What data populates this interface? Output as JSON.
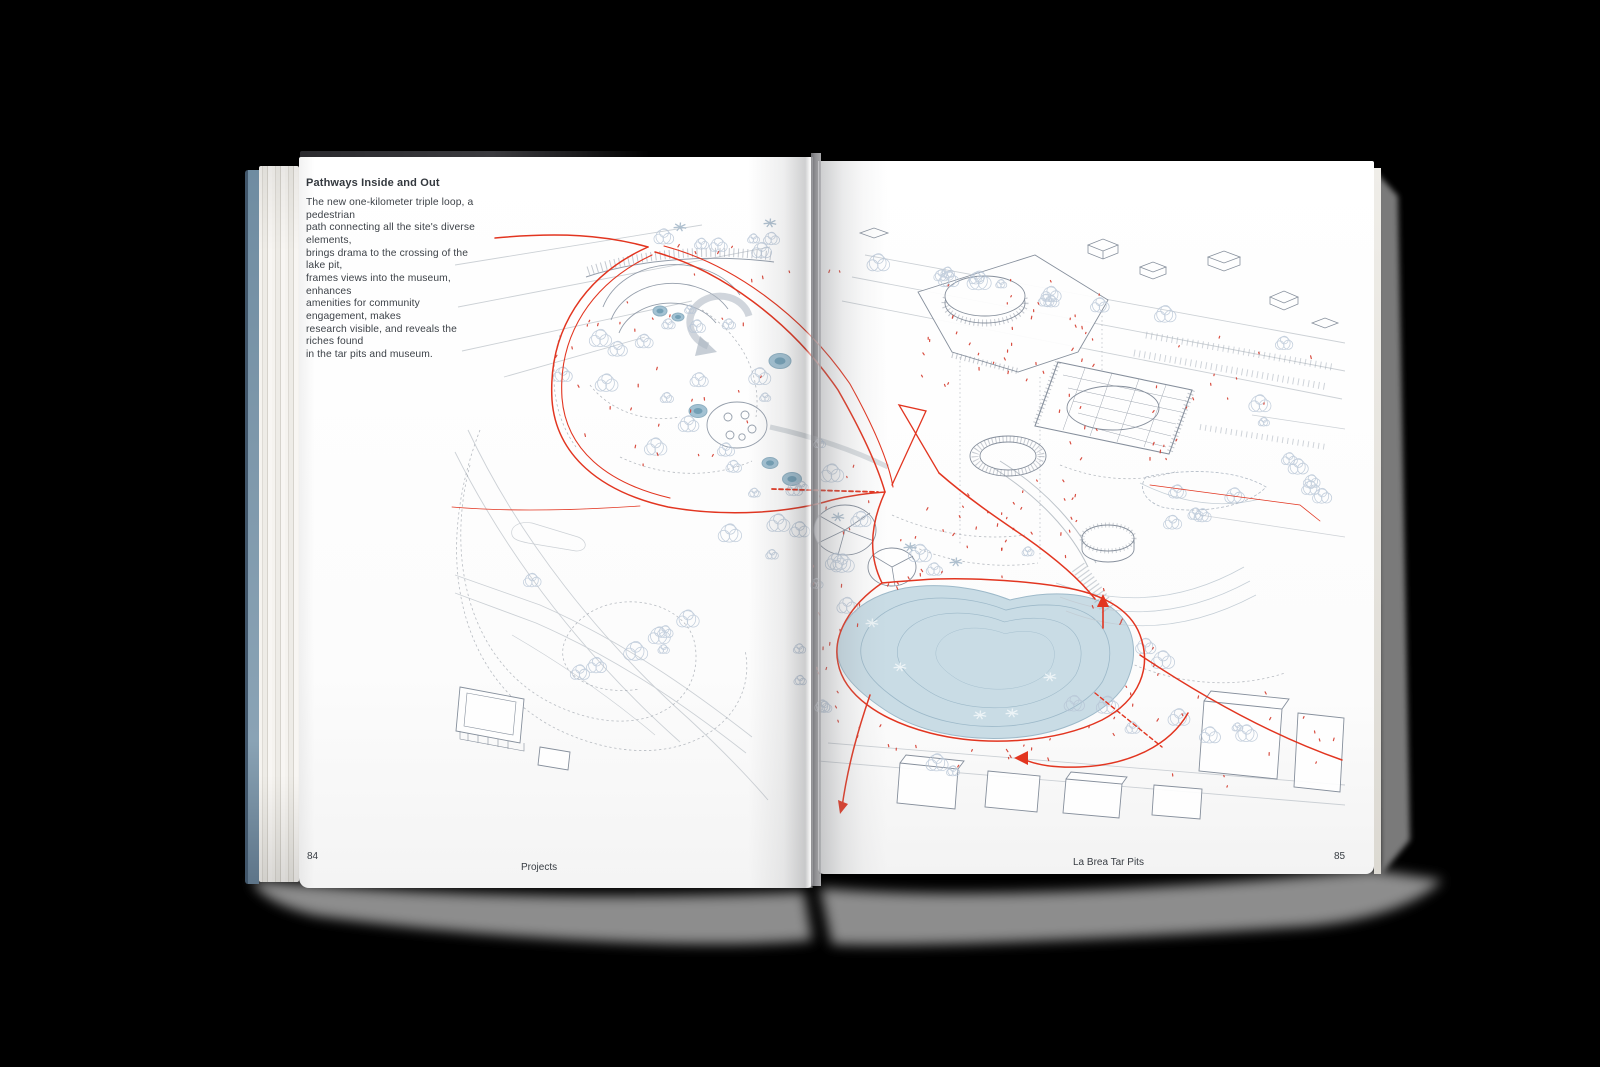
{
  "book": {
    "left_page": {
      "page_number": "84",
      "footer": "Projects",
      "heading": "Pathways Inside and Out",
      "body": "The new one-kilometer triple loop, a pedestrian\npath connecting all the site's diverse elements,\nbrings drama to the crossing of the lake pit,\nframes views into the museum, enhances\namenities for community engagement, makes\nresearch visible, and reveals the riches found\nin the tar pits and museum."
    },
    "right_page": {
      "page_number": "85",
      "footer": "La Brea Tar Pits"
    },
    "drawing": {
      "subject": "Axonometric site plan: red one-kilometer triple-loop pedestrian path, lake pit, museum and park",
      "colors": {
        "path_red": "#e23520",
        "people_red": "#d43a2c",
        "lake_outer": "#c9dce5",
        "lake_mid": "#a3c2d3",
        "lake_core": "#80aabf",
        "lake_deep": "#74a0b6",
        "tree_line": "#b7c5d6",
        "building_line": "#7c8694",
        "street_line": "#c0c6cc",
        "contour_line": "#a0a6ae",
        "palm_light": "#edf4f7",
        "palm_dark": "#aebfce"
      }
    }
  }
}
